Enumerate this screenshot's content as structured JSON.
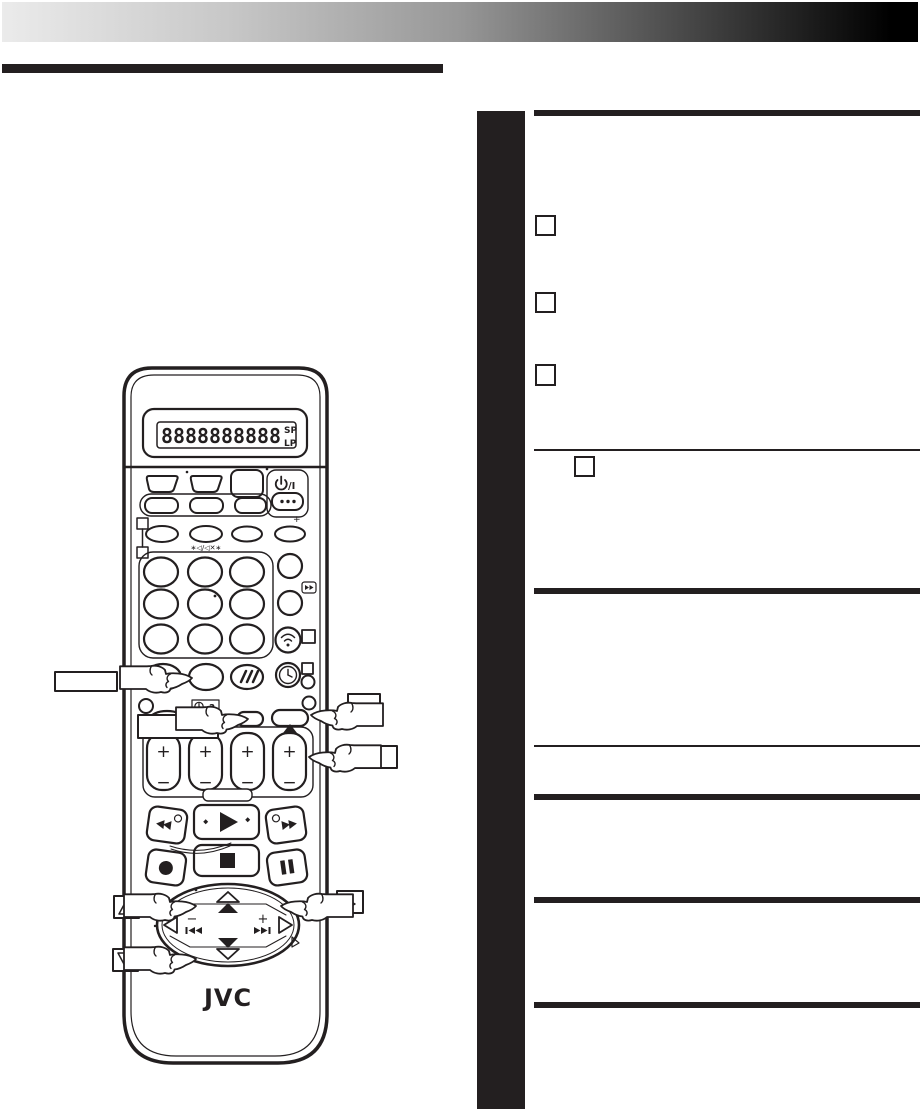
{
  "page": {
    "kind": "scanned manual page",
    "background": "#ffffff",
    "ink": "#231f20"
  },
  "header_bar": {
    "gradient_from": "#ebebeb",
    "gradient_mid": "#979797",
    "gradient_to": "#000000"
  },
  "sidebar": {
    "color": "#231f20"
  },
  "right_column": {
    "rule_color": "#231f20",
    "checkbox_count": 4
  },
  "remote": {
    "brand": "JVC",
    "lcd": {
      "digits": "8888888888",
      "speed_top": "SP",
      "speed_bottom": "LP"
    },
    "power_label": "/I",
    "plus_mark": "+",
    "mute_label": "∗◁/◁✕∗",
    "clock_help_label": "?",
    "rocker_plus": "+",
    "rocker_minus": "−",
    "nav_minus": "−",
    "nav_plus": "+"
  }
}
